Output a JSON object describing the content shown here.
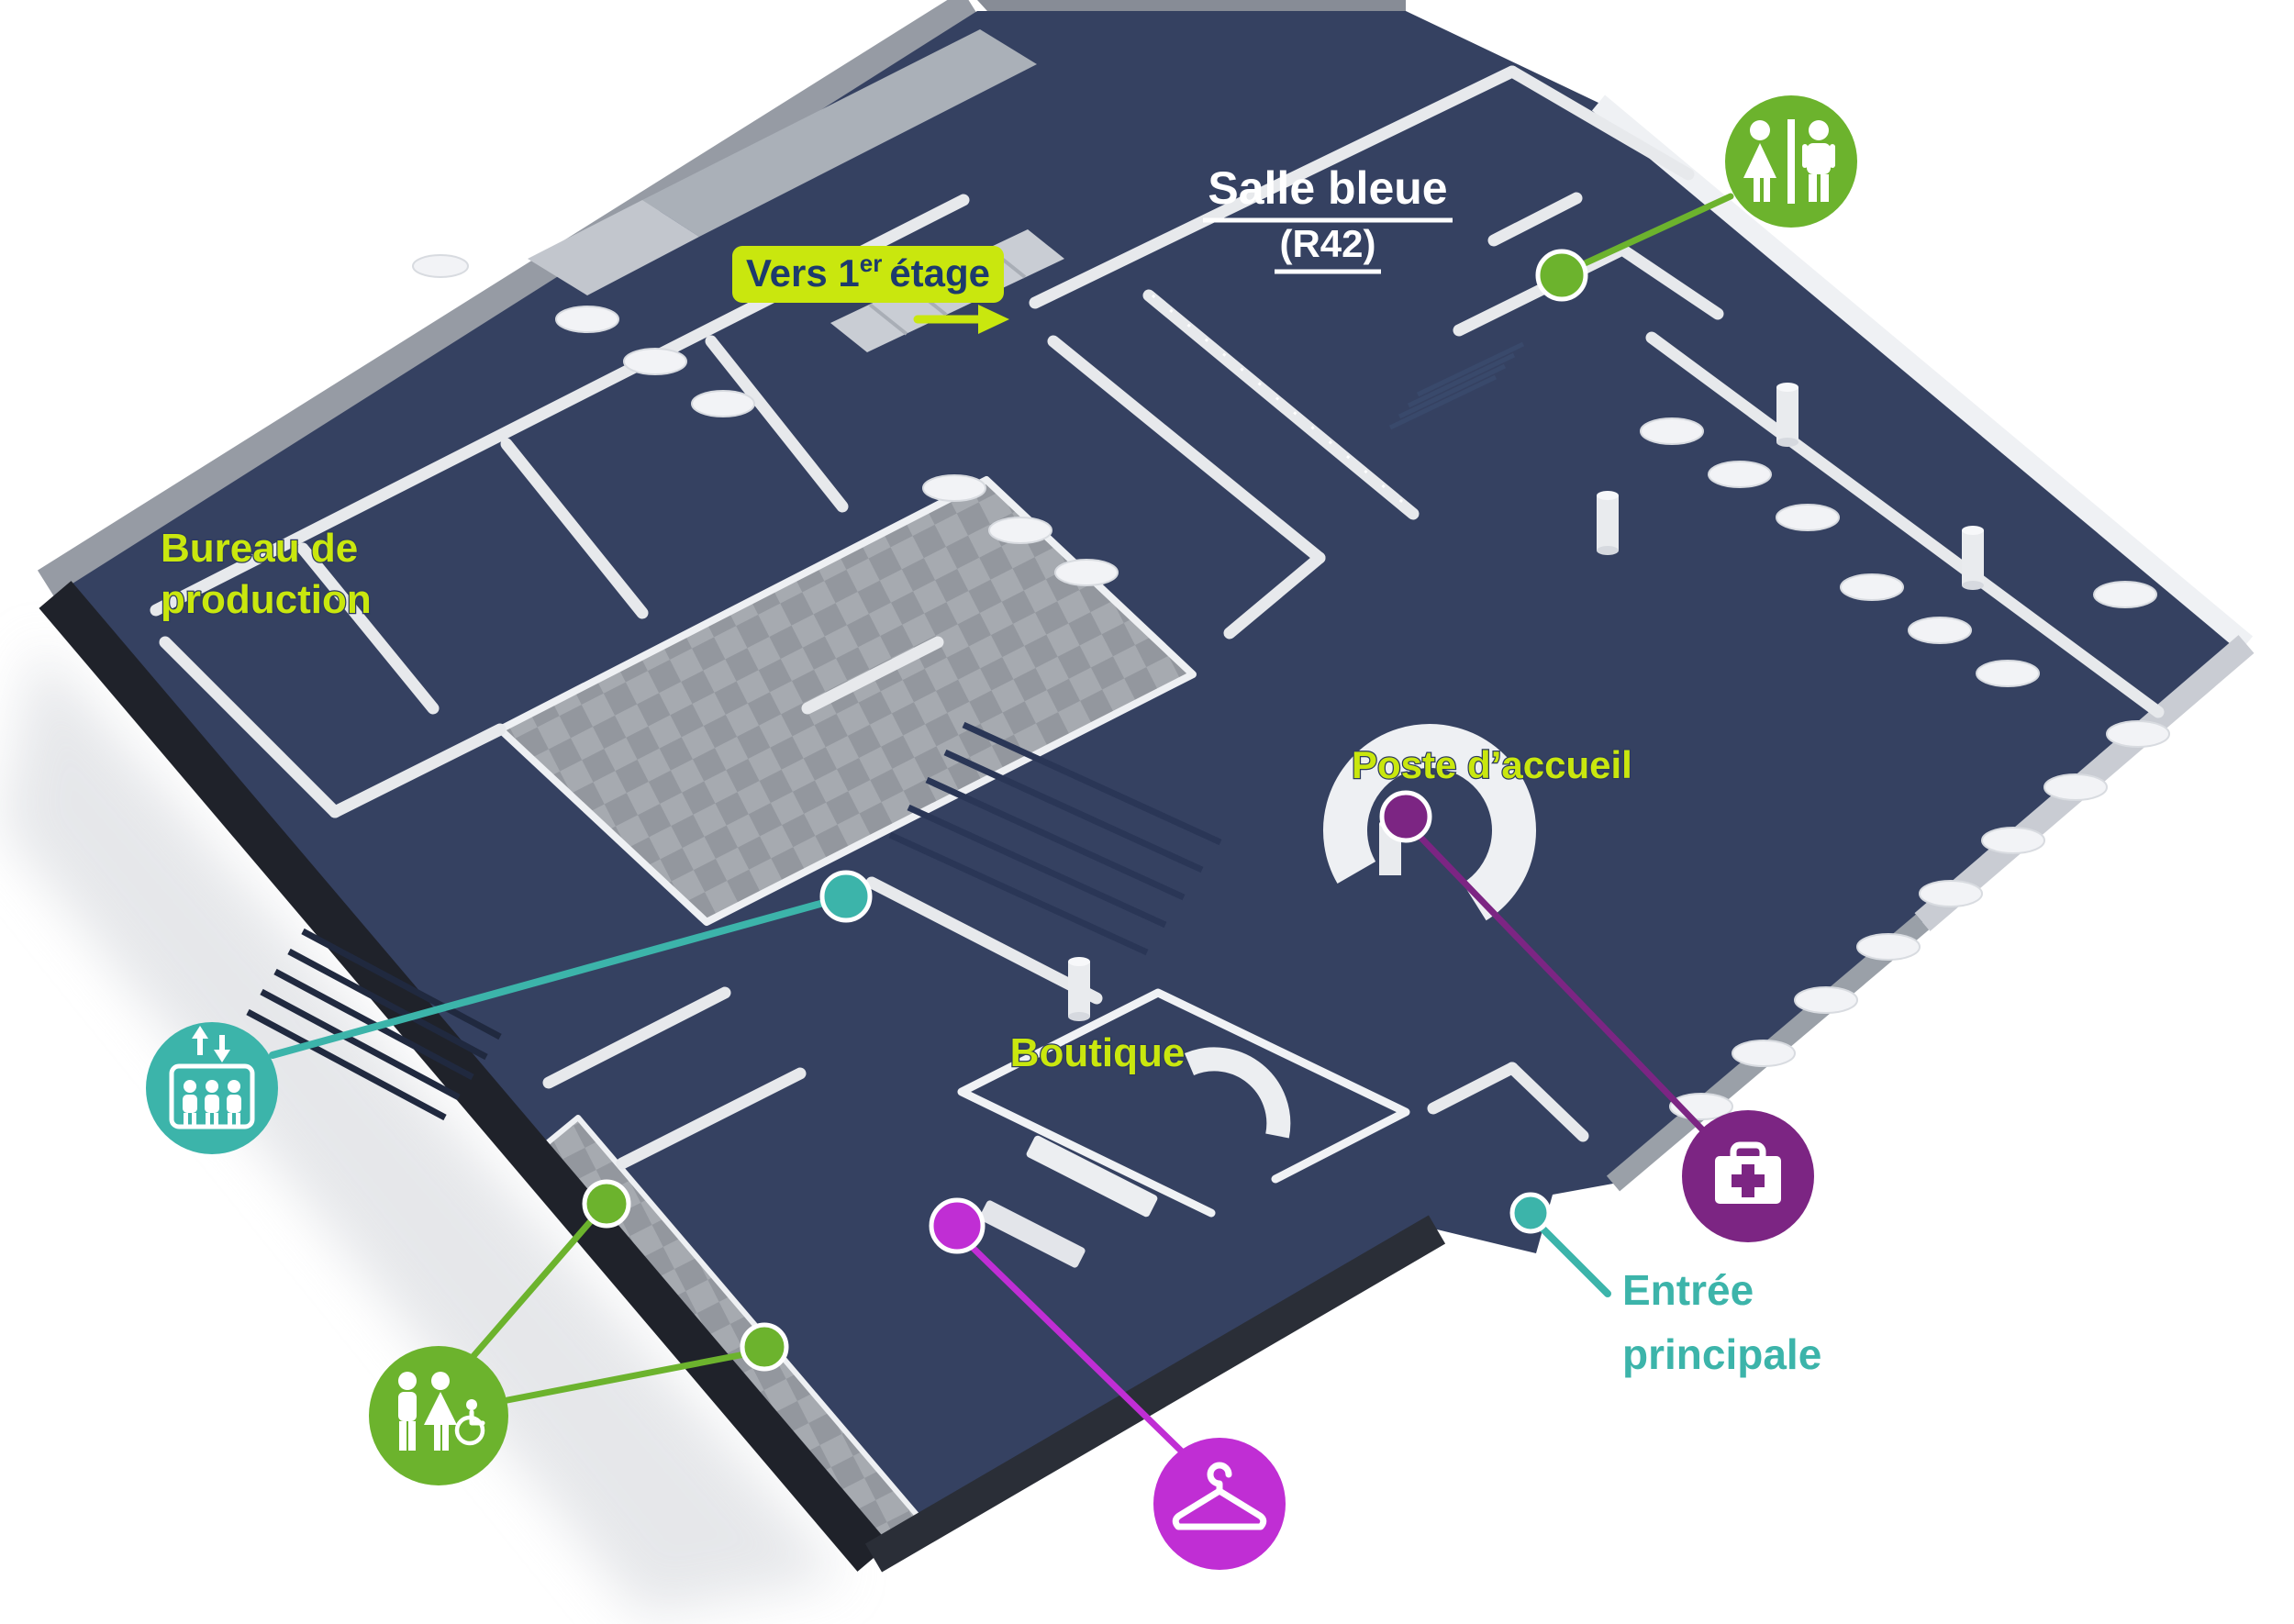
{
  "colors": {
    "chartreuse": "#c9e70e",
    "green": "#6cb32d",
    "teal": "#3cb4aa",
    "purple": "#7c2583",
    "magenta": "#c02ed4",
    "white": "#ffffff",
    "navy_text": "#1d3a6d",
    "floor_navy": "#354161",
    "wall_light": "#e7e9ec",
    "wall_dark": "#20232b"
  },
  "labels": {
    "salle_bleue": {
      "title": "Salle bleue",
      "code": "(R42)"
    },
    "vers_etage": {
      "prefix": "Vers 1",
      "sup": "er",
      "suffix": "étage"
    },
    "bureau_production": {
      "line1": "Bureau de",
      "line2": "production"
    },
    "poste_accueil": {
      "text": "Poste d’accueil"
    },
    "boutique": {
      "text": "Boutique"
    },
    "entree_principale": {
      "line1": "Entrée",
      "line2": "principale"
    }
  },
  "icons": {
    "toilets": {
      "name": "toilets",
      "color": "#6cb32d"
    },
    "elevator": {
      "name": "elevator",
      "color": "#3cb4aa"
    },
    "family_accessible_toilets": {
      "name": "family-accessible-toilets",
      "color": "#6cb32d"
    },
    "first_aid": {
      "name": "first-aid",
      "color": "#7c2583"
    },
    "cloakroom": {
      "name": "cloakroom",
      "color": "#c02ed4"
    }
  }
}
